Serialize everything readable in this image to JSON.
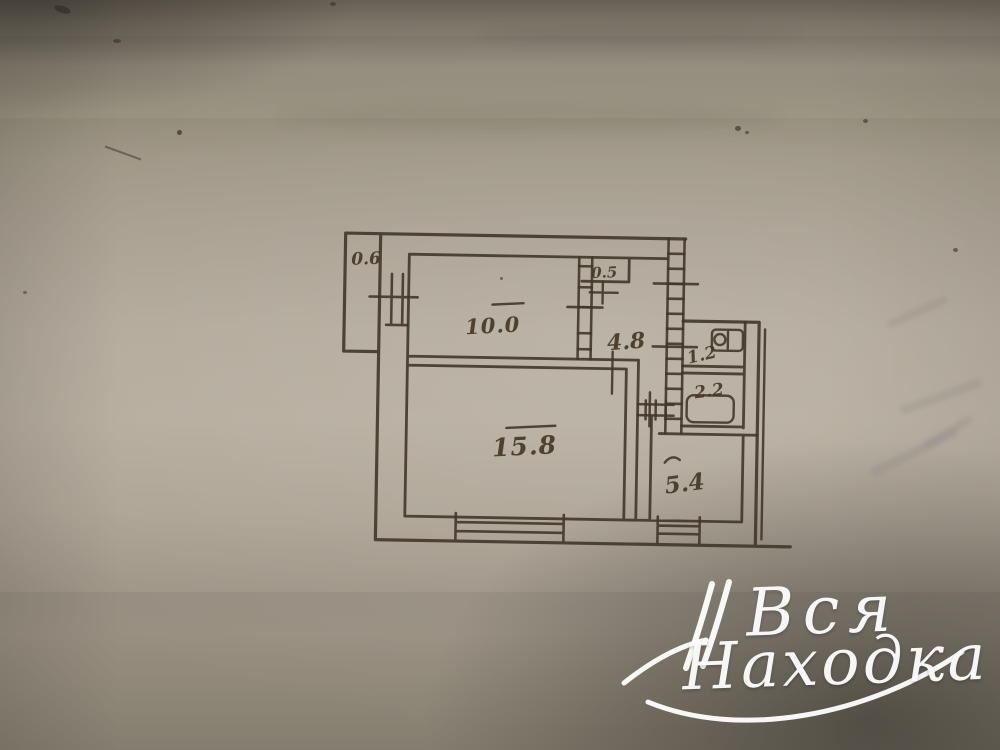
{
  "scene": {
    "description": "Photograph of a hand-drawn apartment floor plan on aged beige paper",
    "paper_color": "#b5ac9d",
    "ink_color": "#42362a",
    "watermark_color": "#ffffff"
  },
  "floor_plan": {
    "rooms": [
      {
        "name": "balcony",
        "area": "0.6"
      },
      {
        "name": "room-10",
        "area": "10.0"
      },
      {
        "name": "closet",
        "area": "0.5"
      },
      {
        "name": "hallway",
        "area": "4.8"
      },
      {
        "name": "toilet",
        "area": "1.2"
      },
      {
        "name": "bathroom",
        "area": "2.2"
      },
      {
        "name": "living-room",
        "area": "15.8"
      },
      {
        "name": "kitchen",
        "area": "5.4"
      }
    ]
  },
  "watermark": {
    "line1": "Вся",
    "line2": "Находка"
  }
}
